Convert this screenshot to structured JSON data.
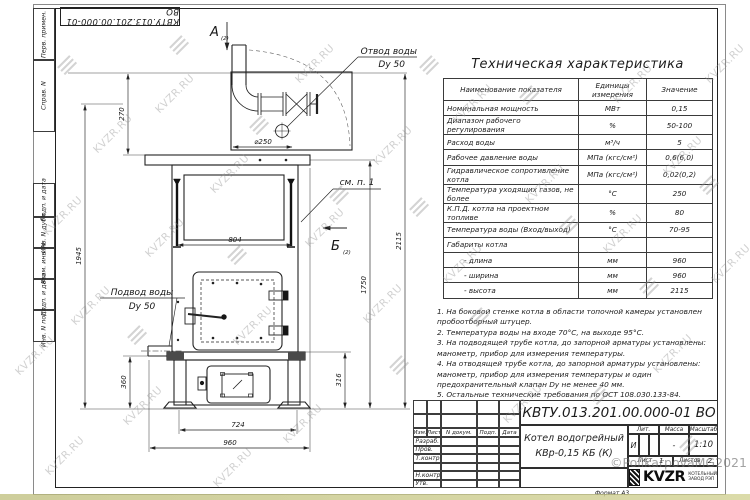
{
  "watermark": {
    "text": "KVZR.RU",
    "copyright": "©PolikarpovaMG2021"
  },
  "margin_labels": [
    "Перв. примен.",
    "Справ. N",
    "Подп. и дата",
    "Инв. N дубл.",
    "Взам. инв. N",
    "Подп. и дата",
    "Инв. N подл."
  ],
  "drawing": {
    "view_a": "А",
    "view_b": "Б",
    "view_ref": "(2)",
    "outlet_label_1": "Отвод воды",
    "outlet_label_2": "Dy 50",
    "inlet_label_1": "Подвод воды",
    "inlet_label_2": "Dy 50",
    "note_ref": "см. п. 1",
    "dims": {
      "chimney_offset": "270",
      "diameter": "⌀250",
      "opening_width": "804",
      "height_left": "1945",
      "height_total": "2115",
      "height_body": "1750",
      "inlet_height": "360",
      "base_height": "316",
      "base_width": "724",
      "overall_width": "960"
    }
  },
  "table": {
    "title": "Техническая характеристика",
    "headers": [
      "Наименование показателя",
      "Единицы измерения",
      "Значение"
    ],
    "rows": [
      [
        "Номинальная мощность",
        "МВт",
        "0,15"
      ],
      [
        "Диапазон рабочего регулирования",
        "%",
        "50-100"
      ],
      [
        "Расход воды",
        "м³/ч",
        "5"
      ],
      [
        "Рабочее давление воды",
        "МПа (кгс/см²)",
        "0,6(6,0)"
      ],
      [
        "Гидравлическое сопротивление котла",
        "МПа (кгс/см²)",
        "0,02(0,2)"
      ],
      [
        "Температура уходящих газов, не более",
        "°С",
        "250"
      ],
      [
        "К.П.Д. котла на проектном топливе",
        "%",
        "80"
      ],
      [
        "Температура воды (Вход/выход)",
        "°С",
        "70-95"
      ],
      [
        "Габариты котла",
        "",
        ""
      ],
      [
        "- длина",
        "мм",
        "960"
      ],
      [
        "- ширина",
        "мм",
        "960"
      ],
      [
        "- высота",
        "мм",
        "2115"
      ]
    ]
  },
  "notes": [
    "1. На боковой стенке котла в области топочной камеры установлен пробоотборный штуцер.",
    "2. Температура воды на входе 70°С, на выходе 95°С.",
    "3. На подводящей трубе котла, до запорной арматуры установлены: манометр, прибор для измерения температуры.",
    "4. На отводящей трубе котла, до запорной арматуры установлены: манометр, прибор для измерения температуры и один предохранительный клапан Dy не менее 40 мм.",
    "5. Остальные технические требования по ОСТ 108.030.133-84."
  ],
  "title_block": {
    "designation": "КВТУ.013.201.00.000-01 ВО",
    "product_name_1": "Котел водогрейный",
    "product_name_2": "КВр-0,15 КБ (К)",
    "header_cols": [
      "Изм.",
      "Лист",
      "N докум.",
      "Подп.",
      "Дата"
    ],
    "sign_rows": [
      "Разраб.",
      "Пров.",
      "Т.контр.",
      "",
      "Н.контр.",
      "Утв."
    ],
    "lit_label": "Лит.",
    "mass_label": "Масса",
    "scale_label": "Масштаб",
    "lit_value": "И",
    "mass_value": "-",
    "scale_value": "1:10",
    "sheet_label": "Лист",
    "sheet_value": "1",
    "sheets_label": "Листов",
    "sheets_value": "2",
    "logo_text": "KVZR",
    "logo_sub_1": "КОТЕЛЬНЫЙ",
    "logo_sub_2": "ЗАВОД РЭП",
    "format_label": "Формат А3"
  }
}
